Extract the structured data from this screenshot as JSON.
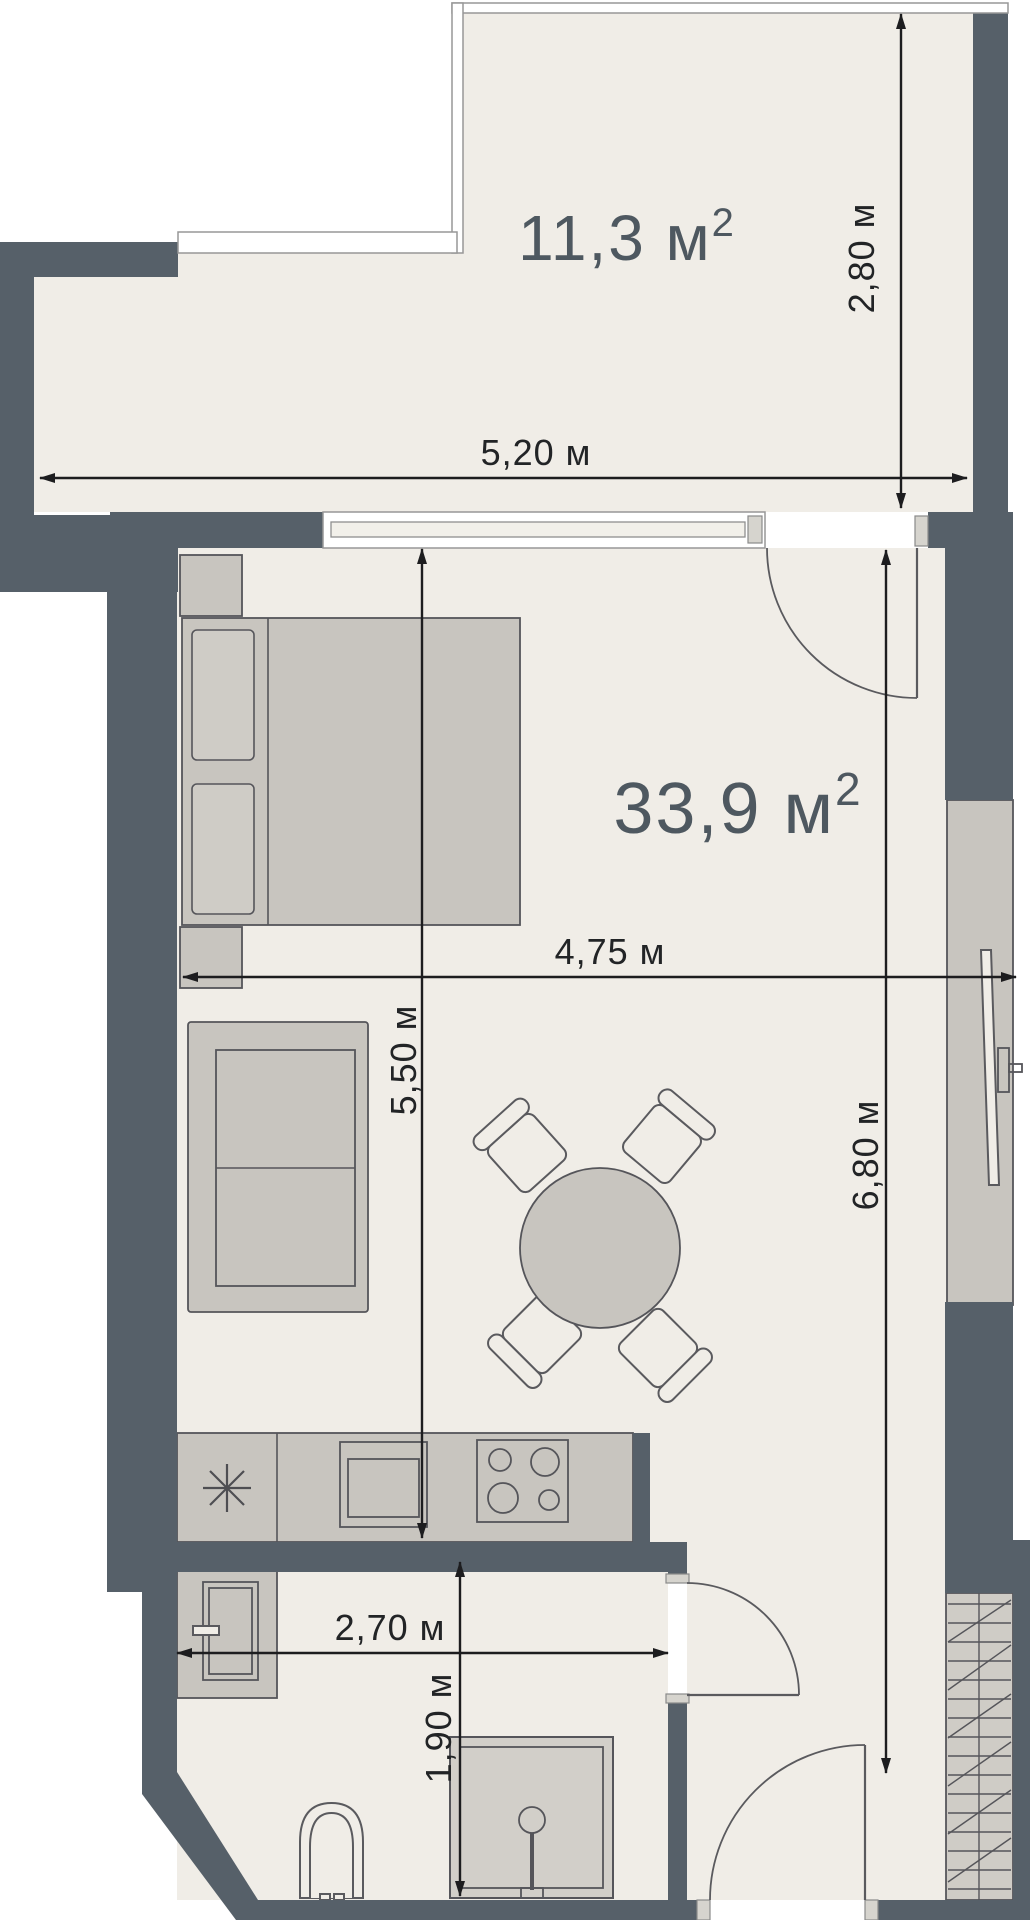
{
  "plan": {
    "type": "apartment-floor-plan",
    "colors": {
      "wall": "#566069",
      "floor": "#F0EDE7",
      "furniture": "#C8C5BF",
      "furniture_light": "#CFCCC6",
      "dimension": "#1D1D1F",
      "area_label": "#4E5860",
      "background": "#FFFFFF"
    },
    "rooms": [
      {
        "id": "balcony",
        "area_label": "11,3 м",
        "area_sup": "2"
      },
      {
        "id": "living-room",
        "area_label": "33,9 м",
        "area_sup": "2"
      }
    ],
    "dimensions": [
      {
        "id": "balcony-width",
        "label": "5,20 м"
      },
      {
        "id": "balcony-depth",
        "label": "2,80 м"
      },
      {
        "id": "room-width",
        "label": "4,75 м"
      },
      {
        "id": "room-depth",
        "label": "5,50 м"
      },
      {
        "id": "total-depth",
        "label": "6,80 м"
      },
      {
        "id": "bathroom-width",
        "label": "2,70 м"
      },
      {
        "id": "bathroom-depth",
        "label": "1,90 м"
      }
    ]
  }
}
